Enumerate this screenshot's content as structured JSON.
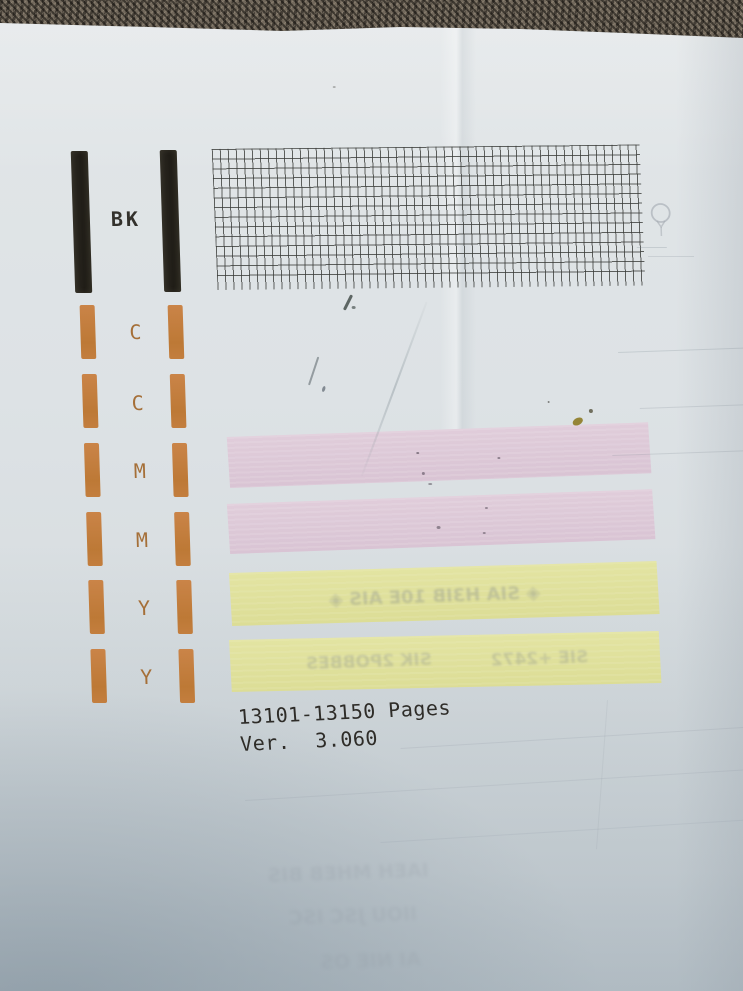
{
  "scene": {
    "kind": "photo-of-printer-nozzle-check-page",
    "carpet_color": "#6a6257",
    "paper_color": "#dde2e5"
  },
  "test_page": {
    "black_section": {
      "label": "BK",
      "bar_color": "#25221b",
      "bar_count": 2
    },
    "grid_pattern": {
      "columns": 53,
      "rows": 14,
      "line_color": "#3a3c39"
    },
    "color_section": {
      "labels": [
        "C",
        "C",
        "M",
        "M",
        "Y",
        "Y"
      ],
      "bar_color": "#c37e3e",
      "label_color": "#a56f38",
      "columns": 2,
      "segments_per_column": 6
    },
    "magenta_bands": {
      "count": 2,
      "color": "#ddc9d8"
    },
    "yellow_bands": {
      "count": 2,
      "color": "#e0e19c"
    },
    "footer": {
      "line1": "13101-13150 Pages",
      "line2": "Ver.  3.060"
    }
  },
  "showthrough": {
    "symbol": "balloon-mark",
    "band1_text": "◈ SIA H3IB 10E AIS ◈",
    "band2_text_left": "SIK 2POBBES",
    "band2_text_right": "SIE +2472",
    "bottom_text1": "IAEH MHEB BIS",
    "bottom_text2": "IIOU JSC ISC",
    "bottom_text3": "AI NIE OS"
  }
}
